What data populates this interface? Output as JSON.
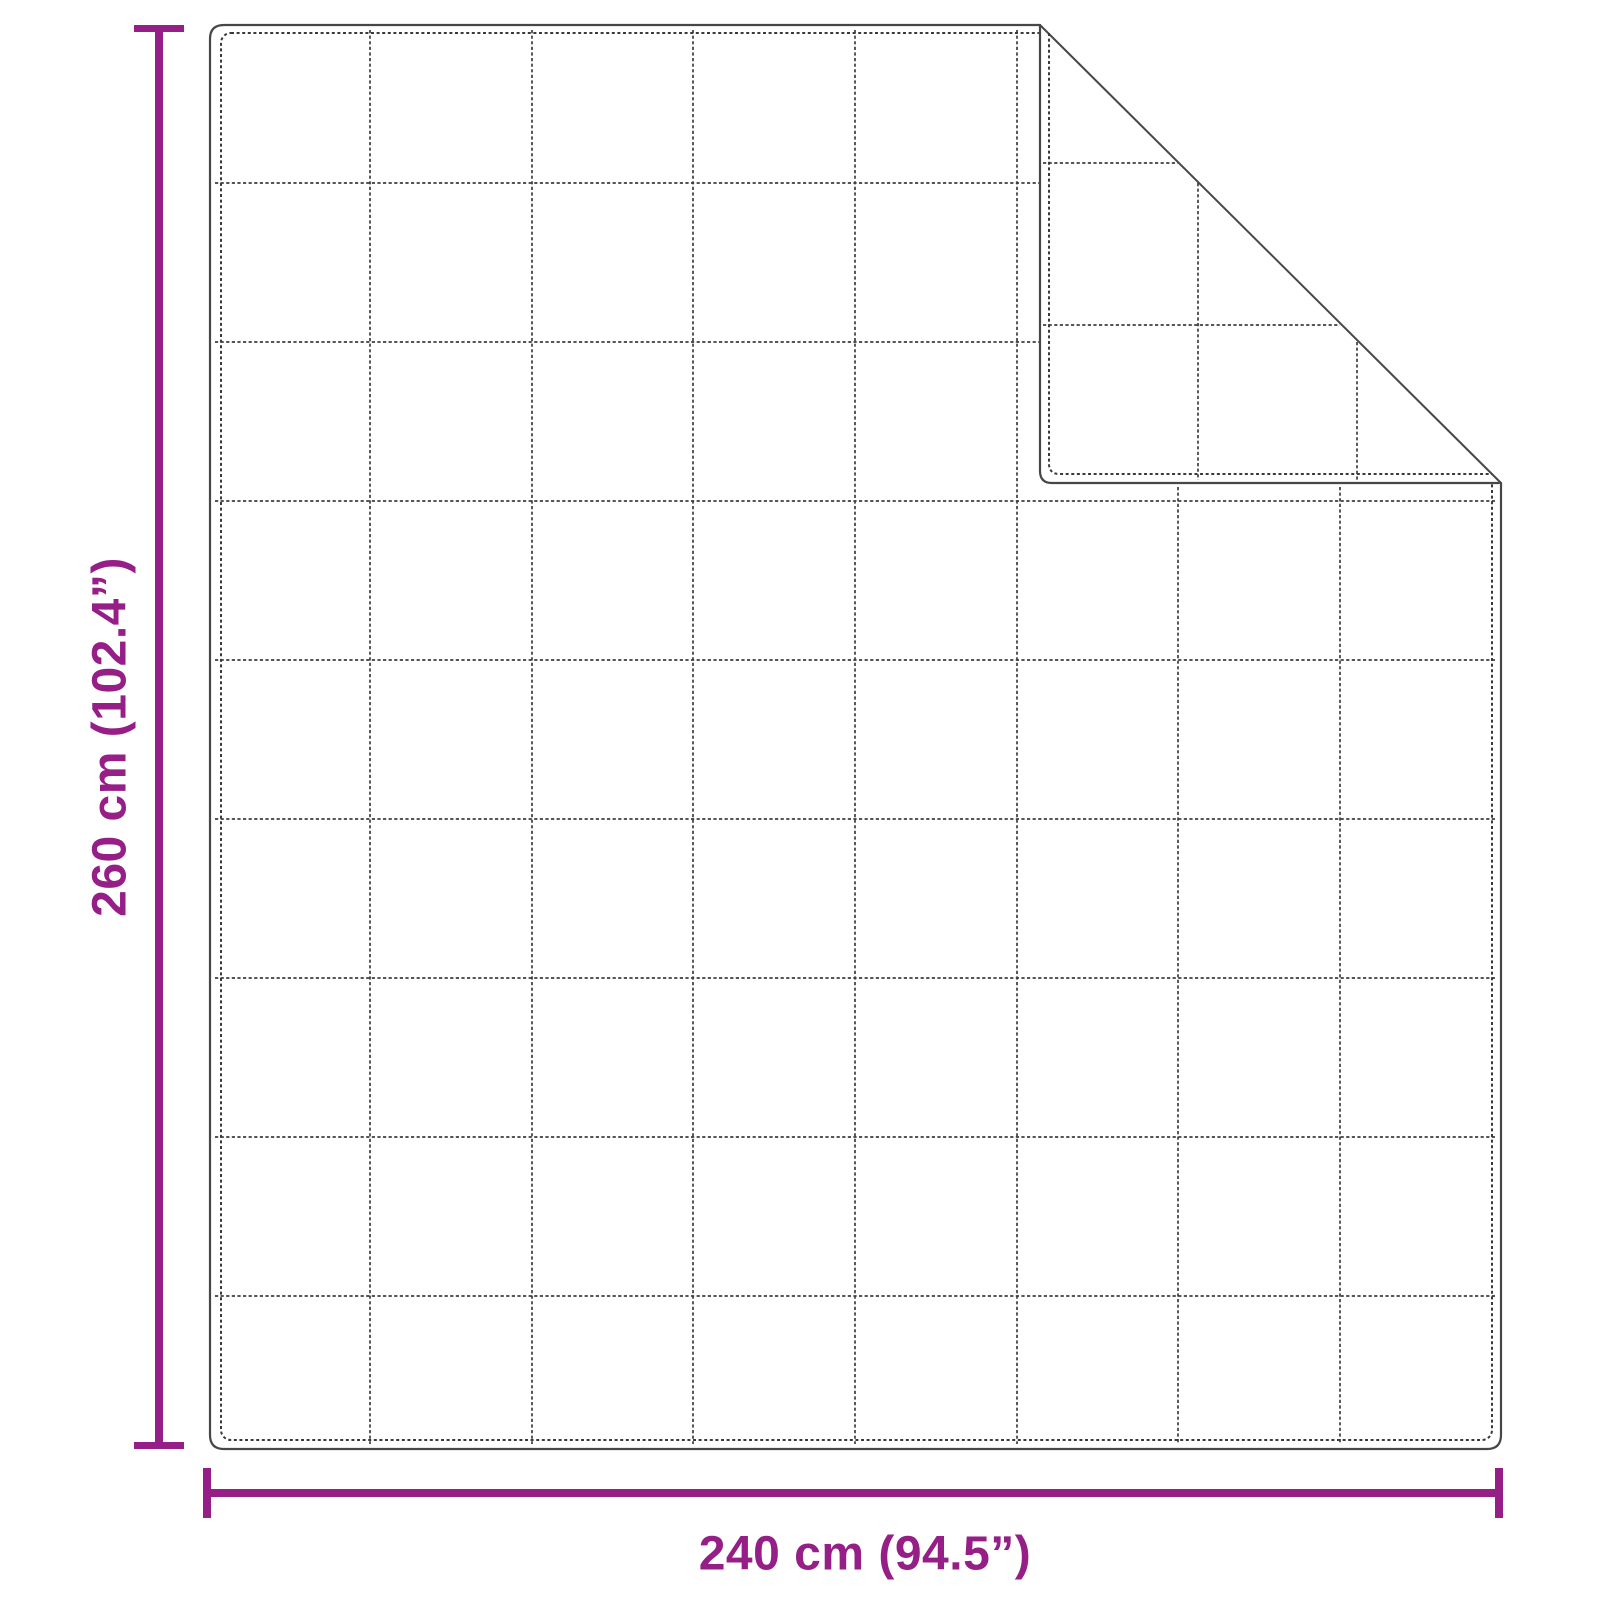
{
  "diagram": {
    "title": "Blanket size diagram",
    "object": "quilted blanket with top-right corner folded over",
    "grid": {
      "columns": 8,
      "rows": 9
    },
    "dimensions": {
      "height": {
        "label": "260 cm (102.4”)",
        "value_cm": 260,
        "value_inch": 102.4
      },
      "width": {
        "label": "240 cm (94.5”)",
        "value_cm": 240,
        "value_inch": 94.5
      }
    },
    "colors": {
      "dimension_accent": "#951e87",
      "outline": "#474747",
      "background": "#ffffff"
    }
  }
}
